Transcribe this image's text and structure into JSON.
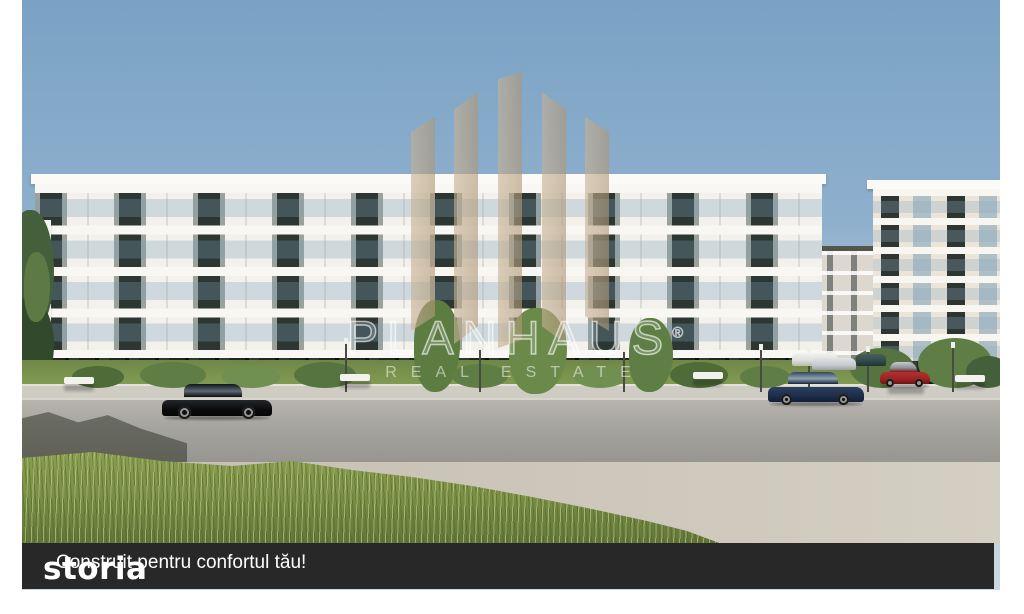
{
  "image": {
    "type": "architectural-render-photo",
    "caption": "Construit pentru confortul tău!",
    "overlay_logo": "storia"
  },
  "watermark": {
    "brand": "PLANHAUS",
    "registered": "®",
    "tagline": "REAL ESTATE",
    "logo_icon": "planhaus-bars-icon"
  },
  "colors": {
    "sky_top": "#7aa2c4",
    "sky_horizon": "#bdd0dd",
    "facade_white": "#f2f1ec",
    "facade_grey": "#9aa29b",
    "window_dark": "#2c3733",
    "logo_tan": "#c7b294",
    "caption_bar": "#282828",
    "caption_text": "#ffffff",
    "grass": "#7a9146",
    "road": "#a5a39d",
    "pavement": "#cdc7bb"
  },
  "scene": {
    "elements": [
      "apartment-building-main",
      "apartment-building-right",
      "apartment-building-distant",
      "parked-cars",
      "street-bollards",
      "benches",
      "hedges",
      "foreground-grass",
      "road",
      "sidewalk",
      "trees"
    ]
  }
}
